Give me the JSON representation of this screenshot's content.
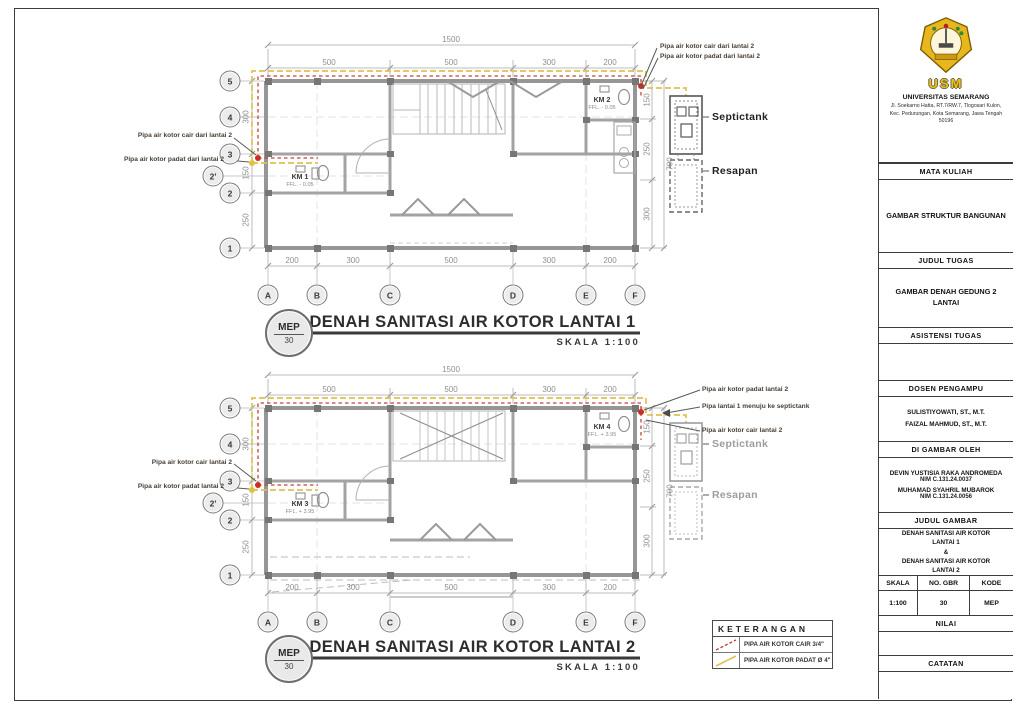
{
  "colors": {
    "pipe_cair": "#c0453a",
    "pipe_padat": "#dfc052",
    "logo_gold": "#f2c200"
  },
  "plans": [
    {
      "badge_code": "MEP",
      "badge_no": "30",
      "title": "DENAH SANITASI AIR KOTOR LANTAI 1",
      "scale_label": "SKALA 1:100",
      "grid_rows": [
        "5",
        "4",
        "3",
        "2'",
        "2",
        "1"
      ],
      "grid_cols": [
        "A",
        "B",
        "C",
        "D",
        "E",
        "F"
      ],
      "dim_total": "1500",
      "dims_top": [
        "500",
        "500",
        "300",
        "200"
      ],
      "dims_bottom": [
        "200",
        "300",
        "500",
        "300",
        "200"
      ],
      "dims_left": [
        "300",
        "150",
        "250"
      ],
      "dims_right": [
        "150",
        "250",
        "300"
      ],
      "dim_right_outer": "700",
      "rooms": [
        {
          "name": "KM 1",
          "ffl": "FFL. - 0.05"
        },
        {
          "name": "KM 2",
          "ffl": "FFL. - 0.05"
        }
      ],
      "septictank_label": "Septictank",
      "resapan_label": "Resapan",
      "ann_left": [
        "Pipa air kotor cair dari lantai 2",
        "Pipa air kotor padat dari lantai 2"
      ],
      "ann_right": [
        "Pipa air kotor cair dari lantai 2",
        "Pipa air kotor padat dari lantai 2"
      ]
    },
    {
      "badge_code": "MEP",
      "badge_no": "30",
      "title": "DENAH SANITASI AIR KOTOR LANTAI 2",
      "scale_label": "SKALA 1:100",
      "grid_rows": [
        "5",
        "4",
        "3",
        "2'",
        "2",
        "1"
      ],
      "grid_cols": [
        "A",
        "B",
        "C",
        "D",
        "E",
        "F"
      ],
      "dim_total": "1500",
      "dims_top": [
        "500",
        "500",
        "300",
        "200"
      ],
      "dims_bottom": [
        "200",
        "300",
        "500",
        "300",
        "200"
      ],
      "dims_left": [
        "300",
        "150",
        "250"
      ],
      "dims_right": [
        "150",
        "250",
        "300"
      ],
      "dim_right_outer": "700",
      "rooms": [
        {
          "name": "KM 3",
          "ffl": "FFL. + 3.95"
        },
        {
          "name": "KM 4",
          "ffl": "FFL. + 3.95"
        }
      ],
      "septictank_label": "Septictank",
      "resapan_label": "Resapan",
      "ann_left": [
        "Pipa air kotor cair lantai 2",
        "Pipa air kotor padat lantai 2"
      ],
      "ann_right": [
        "Pipa air kotor padat lantai 2",
        "Pipa lantai 1 menuju ke septictank",
        "Pipa air kotor cair lantai 2"
      ]
    }
  ],
  "legend": {
    "title": "KETERANGAN",
    "items": [
      {
        "label": "PIPA AIR KOTOR CAIR 3/4\""
      },
      {
        "label": "PIPA AIR KOTOR PADAT Ø 4\""
      }
    ]
  },
  "title_block": {
    "usm": "USM",
    "university": "UNIVERSITAS SEMARANG",
    "address": "Jl. Soekarno Hatta, RT.7/RW.7, Tlogosari Kulon, Kec. Pedurungan, Kota Semarang, Jawa Tengah 50196",
    "mata_kuliah_label": "MATA KULIAH",
    "mata_kuliah": "GAMBAR STRUKTUR BANGUNAN",
    "judul_tugas_label": "JUDUL TUGAS",
    "judul_tugas": "GAMBAR DENAH GEDUNG 2 LANTAI",
    "asistensi_label": "ASISTENSI TUGAS",
    "dosen_label": "DOSEN PENGAMPU",
    "dosen": [
      "SULISTIYOWATI, ST., M.T.",
      "FAIZAL MAHMUD, ST., M.T."
    ],
    "digambar_label": "DI GAMBAR OLEH",
    "digambar": [
      {
        "name": "DEVIN YUSTISIA RAKA ANDROMEDA",
        "nim": "NIM C.131.24.0037"
      },
      {
        "name": "MUHAMAD SYAHRIL MUBAROK",
        "nim": "NIM C.131.24.0056"
      }
    ],
    "judul_gambar_label": "JUDUL GAMBAR",
    "judul_gambar": [
      "DENAH SANITASI AIR KOTOR",
      "LANTAI 1",
      "&",
      "DENAH SANITASI AIR KOTOR",
      "LANTAI 2"
    ],
    "skala_label": "SKALA",
    "no_gbr_label": "NO. GBR",
    "kode_label": "KODE",
    "skala": "1:100",
    "no_gbr": "30",
    "kode": "MEP",
    "nilai_label": "NILAI",
    "catatan_label": "CATATAN"
  }
}
